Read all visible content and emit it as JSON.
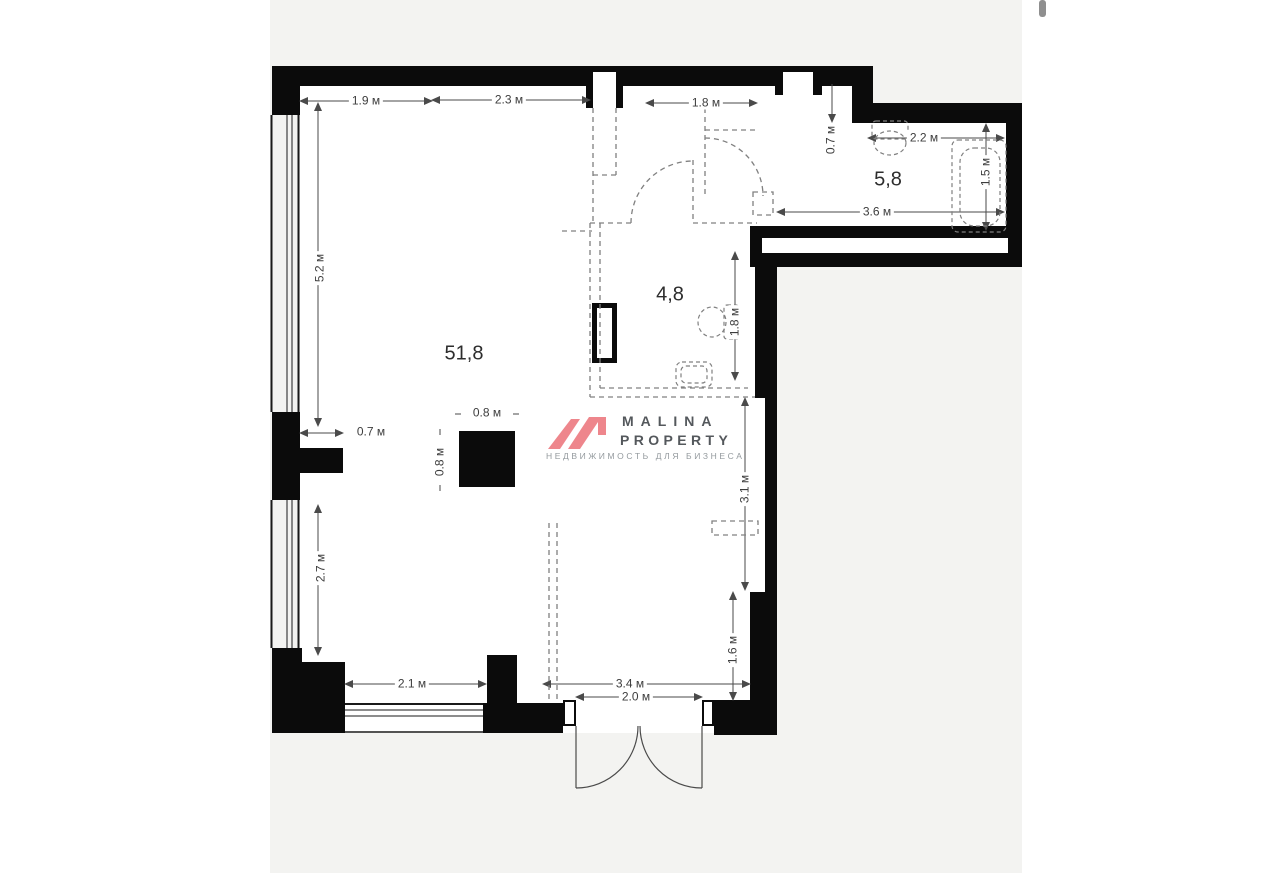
{
  "canvas": {
    "background_color": "#f3f3f1",
    "wall_color": "#0b0b0b",
    "dashed_color": "#808080",
    "dim_line_color": "#4a4a4a"
  },
  "rooms": {
    "main": {
      "label": "51,8"
    },
    "hall": {
      "label": "4,8"
    },
    "bath": {
      "label": "5,8"
    }
  },
  "dims": {
    "top_19": {
      "label": "1.9 м"
    },
    "top_23": {
      "label": "2.3 м"
    },
    "top_18": {
      "label": "1.8 м"
    },
    "bath_07": {
      "label": "0.7 м"
    },
    "bath_22": {
      "label": "2.2 м"
    },
    "bath_15": {
      "label": "1.5 м"
    },
    "bath_36": {
      "label": "3.6 м"
    },
    "left_52": {
      "label": "5.2 м"
    },
    "left_07": {
      "label": "0.7 м"
    },
    "left_27": {
      "label": "2.7 м"
    },
    "hall_18": {
      "label": "1.8 м"
    },
    "right_31": {
      "label": "3.1 м"
    },
    "right_16": {
      "label": "1.6 м"
    },
    "bot_21": {
      "label": "2.1 м"
    },
    "bot_34": {
      "label": "3.4 м"
    },
    "bot_20": {
      "label": "2.0 м"
    },
    "col_w": {
      "label": "0.8 м"
    },
    "col_h": {
      "label": "0.8 м"
    }
  },
  "watermark": {
    "brand_line1": "MALINA",
    "brand_line2": "PROPERTY",
    "tagline": "НЕДВИЖИМОСТЬ ДЛЯ БИЗНЕСА",
    "logo_color": "#ee868c",
    "brand_color": "#54585c",
    "tagline_color": "#949a9e"
  }
}
